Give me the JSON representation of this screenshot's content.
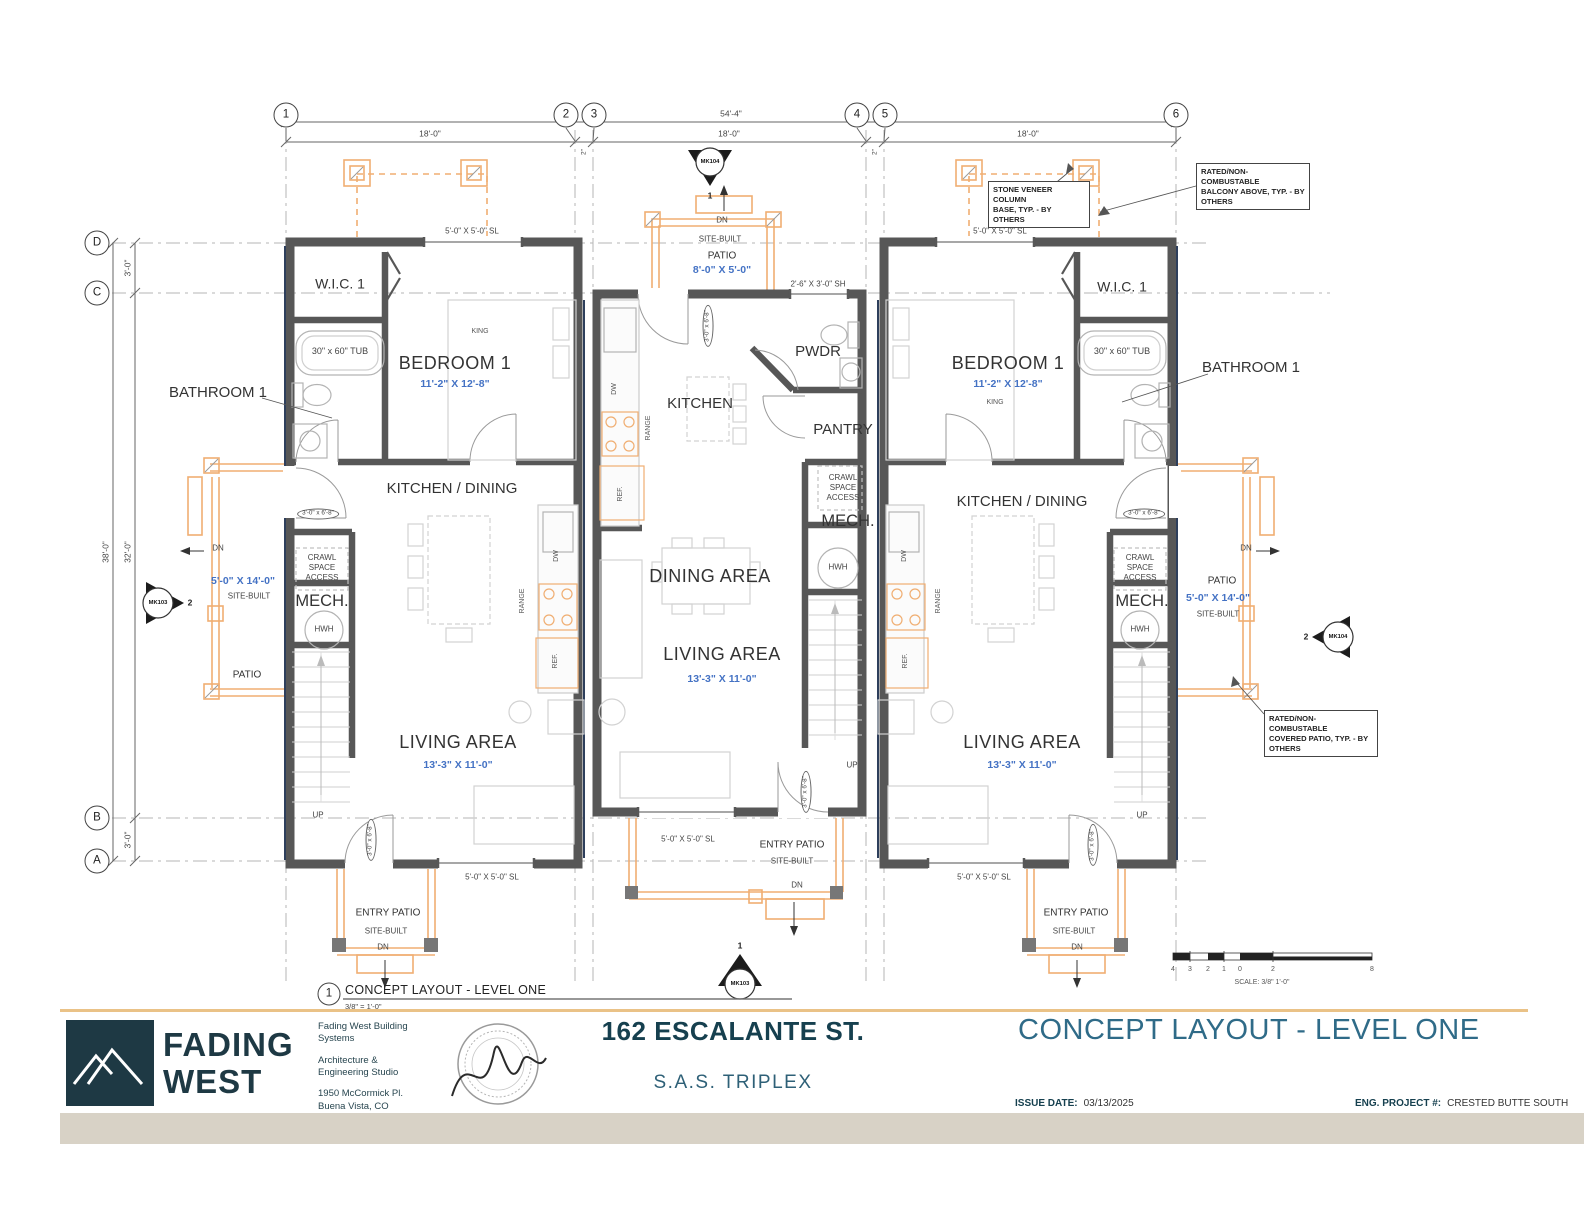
{
  "grid": {
    "cols": [
      "1",
      "2",
      "3",
      "4",
      "5",
      "6"
    ],
    "rows": [
      "D",
      "C",
      "B",
      "A"
    ]
  },
  "dims": {
    "top_overall": "54'-4\"",
    "top_seg": "18'-0\"",
    "top_gap": "2\"",
    "left_overall": "38'-0\"",
    "left_mid": "32'-0\"",
    "left_edge": "3'-0\""
  },
  "markers": {
    "mk103": "MK103",
    "mk104": "MK104",
    "one": "1",
    "two": "2"
  },
  "notes": {
    "stone": "STONE VENEER COLUMN\nBASE, TYP. - BY OTHERS",
    "balcony": "RATED/NON-COMBUSTABLE\nBALCONY ABOVE, TYP. - BY\nOTHERS",
    "covered": "RATED/NON-COMBUSTABLE\nCOVERED PATIO, TYP. - BY\nOTHERS"
  },
  "rooms": {
    "wic": "W.I.C. 1",
    "tub": "30\" x 60\" TUB",
    "bedroom": "BEDROOM 1",
    "bedroom_dim": "11'-2\" X 12'-8\"",
    "king": "KING",
    "bathroom": "BATHROOM 1",
    "kitchen_dining": "KITCHEN / DINING",
    "kitchen": "KITCHEN",
    "pwdr": "PWDR",
    "pantry": "PANTRY",
    "crawl": "CRAWL\nSPACE\nACCESS",
    "mech": "MECH.",
    "hwh": "HWH",
    "dining": "DINING AREA",
    "living": "LIVING AREA",
    "living_dim": "13'-3\" X 11'-0\"",
    "up": "UP",
    "dn": "DN"
  },
  "patio": {
    "patio": "PATIO",
    "entry": "ENTRY PATIO",
    "site_built": "SITE-BUILT",
    "top_dim": "8'-0\" X 5'-0\"",
    "side_dim": "5'-0\" X 14'-0\""
  },
  "openings": {
    "window_sl": "5'-0\" X 5'-0\"   SL",
    "window_sh": "2'-6\" X 3'-0\"   SH",
    "door_tag": "3'-0\" x 6'-8\""
  },
  "appliances": {
    "dw": "DW",
    "range": "RANGE",
    "ref": "REF."
  },
  "view_title": {
    "num": "1",
    "title": "CONCEPT LAYOUT - LEVEL ONE",
    "scale": "3/8\" = 1'-0\""
  },
  "scale_bar": {
    "numbers": [
      "4",
      "3",
      "2",
      "1",
      "0",
      "2",
      "8"
    ],
    "caption": "SCALE: 3/8\" 1'-0\""
  },
  "title_block": {
    "logo_line1": "FADING",
    "logo_line2": "WEST",
    "firm_1": "Fading West Building\nSystems",
    "firm_2": "Architecture &\nEngineering Studio",
    "firm_3": "1950 McCormick Pl.\nBuena Vista, CO\n81211",
    "project_address": "162 ESCALANTE ST.",
    "project_name": "S.A.S. TRIPLEX",
    "sheet_title": "CONCEPT LAYOUT - LEVEL ONE",
    "issue_date_label": "ISSUE DATE:",
    "issue_date": "03/13/2025",
    "eng_label": "ENG. PROJECT #:",
    "eng_value": "CRESTED BUTTE SOUTH"
  },
  "colors": {
    "wall": "#575757",
    "patio_orange": "#f0ae72",
    "dim_blue": "#4472c4",
    "brand_teal": "#1e3944",
    "title_teal": "#2f6b88"
  }
}
